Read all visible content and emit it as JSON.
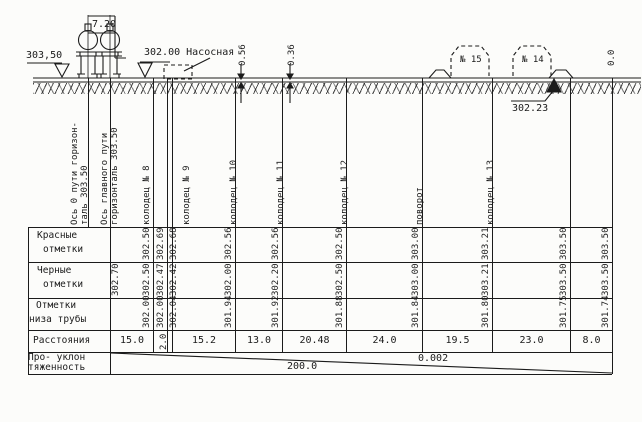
{
  "profile": {
    "left_elevation": "303,50",
    "track_dimension": "7.20",
    "pump_station": "302.00 Насосная",
    "depth_marks": [
      "0.56",
      "0.36"
    ],
    "buildings": [
      "№ 15",
      "№ 14"
    ],
    "benchmark_elevation": "302.23",
    "end_mark": "0.0"
  },
  "ordinates": [
    {
      "id": "axis-track-0",
      "x": 88,
      "label_lines": [
        "Ось 0 пути горизон-",
        "таль 303.50"
      ],
      "label_anchor": 90,
      "line_bottom": 227
    },
    {
      "id": "axis-main-track",
      "x": 110,
      "label_lines": [
        "Ось главного пути",
        "горизонталь 303.50"
      ],
      "label_anchor": 120,
      "line_bottom": 374,
      "black": "302.70",
      "value_anchor": 121
    },
    {
      "id": "well-8",
      "x": 153,
      "label_lines": [
        "колодец № 8"
      ],
      "label_anchor": 152,
      "red": "302.50",
      "black": "302.50",
      "invert": "302.00",
      "value_anchor": 152
    },
    {
      "id": "pump-connection",
      "x": 167,
      "red": "302.69",
      "black": "302.47",
      "invert": "302.00",
      "value_anchor": 166
    },
    {
      "id": "well-9",
      "x": 172,
      "label_lines": [
        "колодец № 9"
      ],
      "label_anchor": 192,
      "red": "302.68",
      "black": "302.42",
      "invert": "302.04",
      "value_anchor": 179
    },
    {
      "id": "well-10",
      "x": 235,
      "label_lines": [
        "колодец № 10"
      ],
      "label_anchor": 239,
      "red": "302.56",
      "black": "302.00",
      "invert": "301.94",
      "value_anchor": 234
    },
    {
      "id": "well-11",
      "x": 282,
      "label_lines": [
        "колодец № 11"
      ],
      "label_anchor": 286,
      "red": "302.56",
      "black": "302.20",
      "invert": "301.92",
      "value_anchor": 281
    },
    {
      "id": "well-12",
      "x": 346,
      "label_lines": [
        "колодец № 12"
      ],
      "label_anchor": 350,
      "red": "302.50",
      "black": "302.50",
      "invert": "301.88",
      "value_anchor": 345
    },
    {
      "id": "turn-point",
      "x": 422,
      "label_lines": [
        "поворот"
      ],
      "label_anchor": 425,
      "red": "303.00",
      "black": "303.00",
      "invert": "301.84",
      "value_anchor": 421
    },
    {
      "id": "well-13",
      "x": 492,
      "label_lines": [
        "колодец № 13"
      ],
      "label_anchor": 496,
      "red": "303.21",
      "black": "303.21",
      "invert": "301.80",
      "value_anchor": 491
    },
    {
      "id": "ordinate-18",
      "x": 570,
      "red": "303.50",
      "black": "303.50",
      "invert": "301.75",
      "value_anchor": 569
    },
    {
      "id": "profile-end",
      "x": 612,
      "line_top": 78,
      "line_bottom": 374,
      "red": "303.50",
      "black": "303.50",
      "invert": "301.74",
      "value_anchor": 611
    }
  ],
  "distances": [
    {
      "value": "15.0",
      "x1": 110,
      "x2": 153
    },
    {
      "value": "2.0",
      "x1": 153,
      "x2": 172,
      "rotated": true
    },
    {
      "value": "15.2",
      "x1": 172,
      "x2": 235
    },
    {
      "value": "13.0",
      "x1": 235,
      "x2": 282
    },
    {
      "value": "20.48",
      "x1": 282,
      "x2": 346
    },
    {
      "value": "24.0",
      "x1": 346,
      "x2": 422
    },
    {
      "value": "19.5",
      "x1": 422,
      "x2": 492
    },
    {
      "value": "23.0",
      "x1": 492,
      "x2": 570
    },
    {
      "value": "8.0",
      "x1": 570,
      "x2": 612
    }
  ],
  "table": {
    "rows": [
      {
        "id": "red-marks",
        "lines": [
          "Красные",
          "отметки"
        ]
      },
      {
        "id": "black-marks",
        "lines": [
          "Черные",
          "отметки"
        ]
      },
      {
        "id": "pipe-invert",
        "lines": [
          "Отметки",
          "низа трубы"
        ]
      },
      {
        "id": "distances",
        "lines": [
          "Расстояния"
        ]
      },
      {
        "id": "length-slope",
        "lines": [
          "Про- уклон",
          "тяженность"
        ]
      }
    ],
    "slope": "0.002",
    "length": "200.0"
  }
}
